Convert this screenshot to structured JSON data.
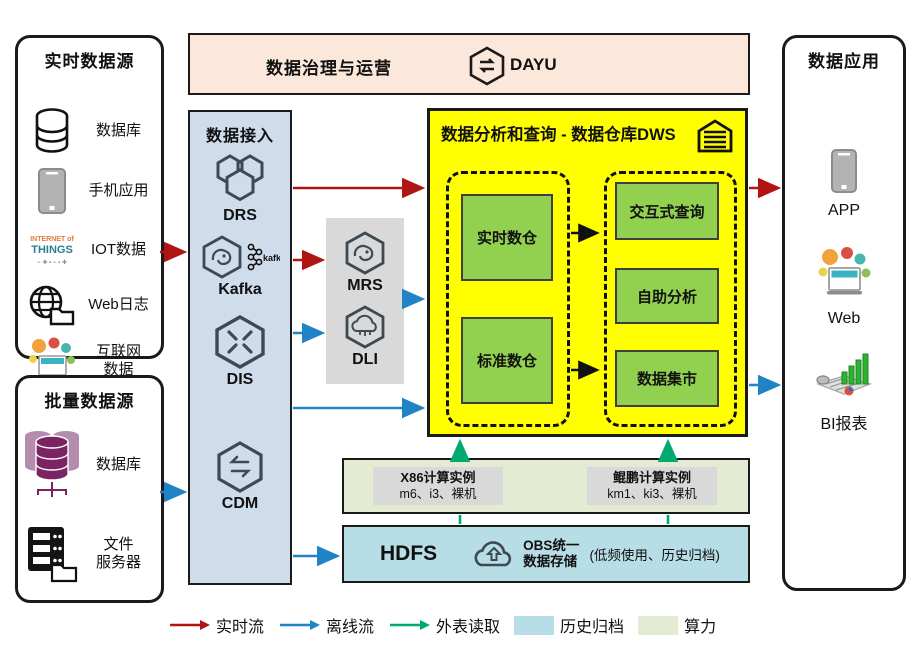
{
  "colors": {
    "dws_yellow": "#ffff00",
    "warehouse_green": "#92d050",
    "ingest_blue": "#cfdcec",
    "banner_peach": "#fbe8db",
    "process_gray": "#d9d9d9",
    "compute_green": "#e3ecd2",
    "storage_blue": "#b7dde6",
    "arrow_red": "#b01513",
    "arrow_blue": "#1f83c6",
    "arrow_green": "#00a971"
  },
  "realtime_sources": {
    "title": "实时数据源",
    "items": [
      {
        "icon": "database-icon",
        "label": "数据库"
      },
      {
        "icon": "mobile-phone-icon",
        "label": "手机应用"
      },
      {
        "icon": "iot-wordcloud-icon",
        "label": "IOT数据"
      },
      {
        "icon": "web-log-icon",
        "label": "Web日志"
      },
      {
        "icon": "internet-data-icon",
        "label": "互联网",
        "label2": "数据"
      }
    ],
    "iot_words": {
      "line1": "INTERNET of",
      "line2": "THINGS"
    }
  },
  "batch_sources": {
    "title": "批量数据源",
    "items": [
      {
        "icon": "database-cluster-icon",
        "label": "数据库"
      },
      {
        "icon": "file-server-icon",
        "label": "文件",
        "label2": "服务器"
      }
    ]
  },
  "governance": {
    "title": "数据治理与运营",
    "product": "DAYU"
  },
  "ingestion": {
    "title": "数据接入",
    "services": [
      "DRS",
      "Kafka",
      "DIS",
      "CDM"
    ],
    "kafka_logo_text": "kafka"
  },
  "processing": {
    "services": [
      "MRS",
      "DLI"
    ]
  },
  "dws": {
    "title": "数据分析和查询 - 数据仓库DWS",
    "warehouses": [
      "实时数仓",
      "标准数仓"
    ],
    "analytics": [
      "交互式查询",
      "自助分析",
      "数据集市"
    ]
  },
  "compute": {
    "instances": [
      {
        "name": "X86计算实例",
        "spec": "m6、i3、裸机"
      },
      {
        "name": "鲲鹏计算实例",
        "spec": "km1、ki3、裸机"
      }
    ]
  },
  "storage": {
    "hdfs": "HDFS",
    "obs_line1": "OBS统一",
    "obs_line2": "数据存储",
    "note": "(低频使用、历史归档)"
  },
  "applications": {
    "title": "数据应用",
    "items": [
      {
        "icon": "app-phone-icon",
        "label": "APP"
      },
      {
        "icon": "web-bubbles-icon",
        "label": "Web"
      },
      {
        "icon": "bi-report-icon",
        "label": "BI报表"
      }
    ]
  },
  "legend": [
    {
      "type": "arrow",
      "color": "#b01513",
      "label": "实时流"
    },
    {
      "type": "arrow",
      "color": "#1f83c6",
      "label": "离线流"
    },
    {
      "type": "arrow",
      "color": "#00a971",
      "label": "外表读取"
    },
    {
      "type": "swatch",
      "color": "#b7dde6",
      "label": "历史归档"
    },
    {
      "type": "swatch",
      "color": "#e3ecd2",
      "label": "算力"
    }
  ]
}
